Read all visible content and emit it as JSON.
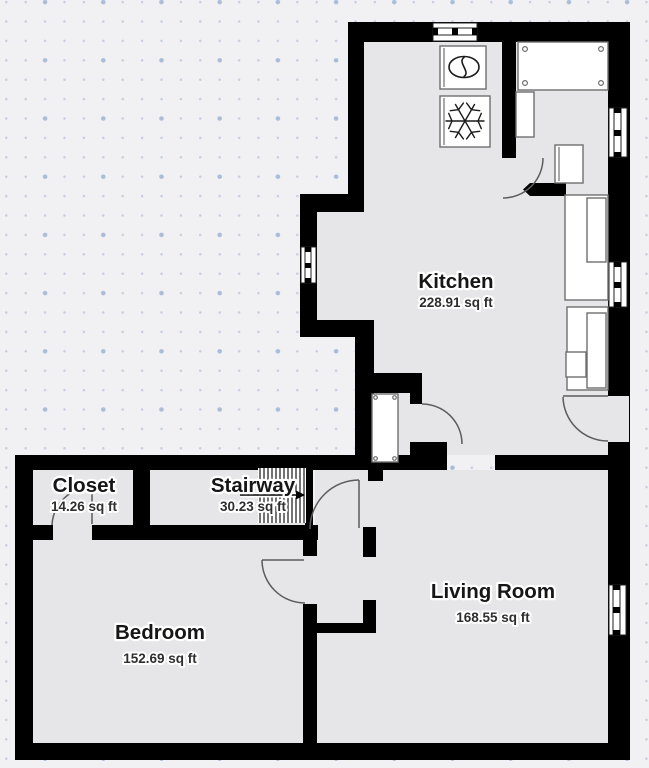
{
  "plan": {
    "rooms": [
      {
        "name": "Kitchen",
        "area": "228.91 sq ft"
      },
      {
        "name": "Closet",
        "area": "14.26 sq ft"
      },
      {
        "name": "Stairway",
        "area": "30.23 sq ft"
      },
      {
        "name": "Bedroom",
        "area": "152.69 sq ft"
      },
      {
        "name": "Living Room",
        "area": "168.55 sq ft"
      }
    ],
    "icons": {
      "stove": "circle-burner-icon",
      "freezer": "snowflake-icon",
      "stairs": "hatch-with-direction-arrow"
    },
    "colors": {
      "wall": "#000000",
      "floor": "#e6e6e8",
      "background": "#f1f1f4",
      "dot_small": "#c5cddf",
      "dot_large": "#a9bdd9",
      "furniture_stroke": "#6e6e6e"
    }
  }
}
